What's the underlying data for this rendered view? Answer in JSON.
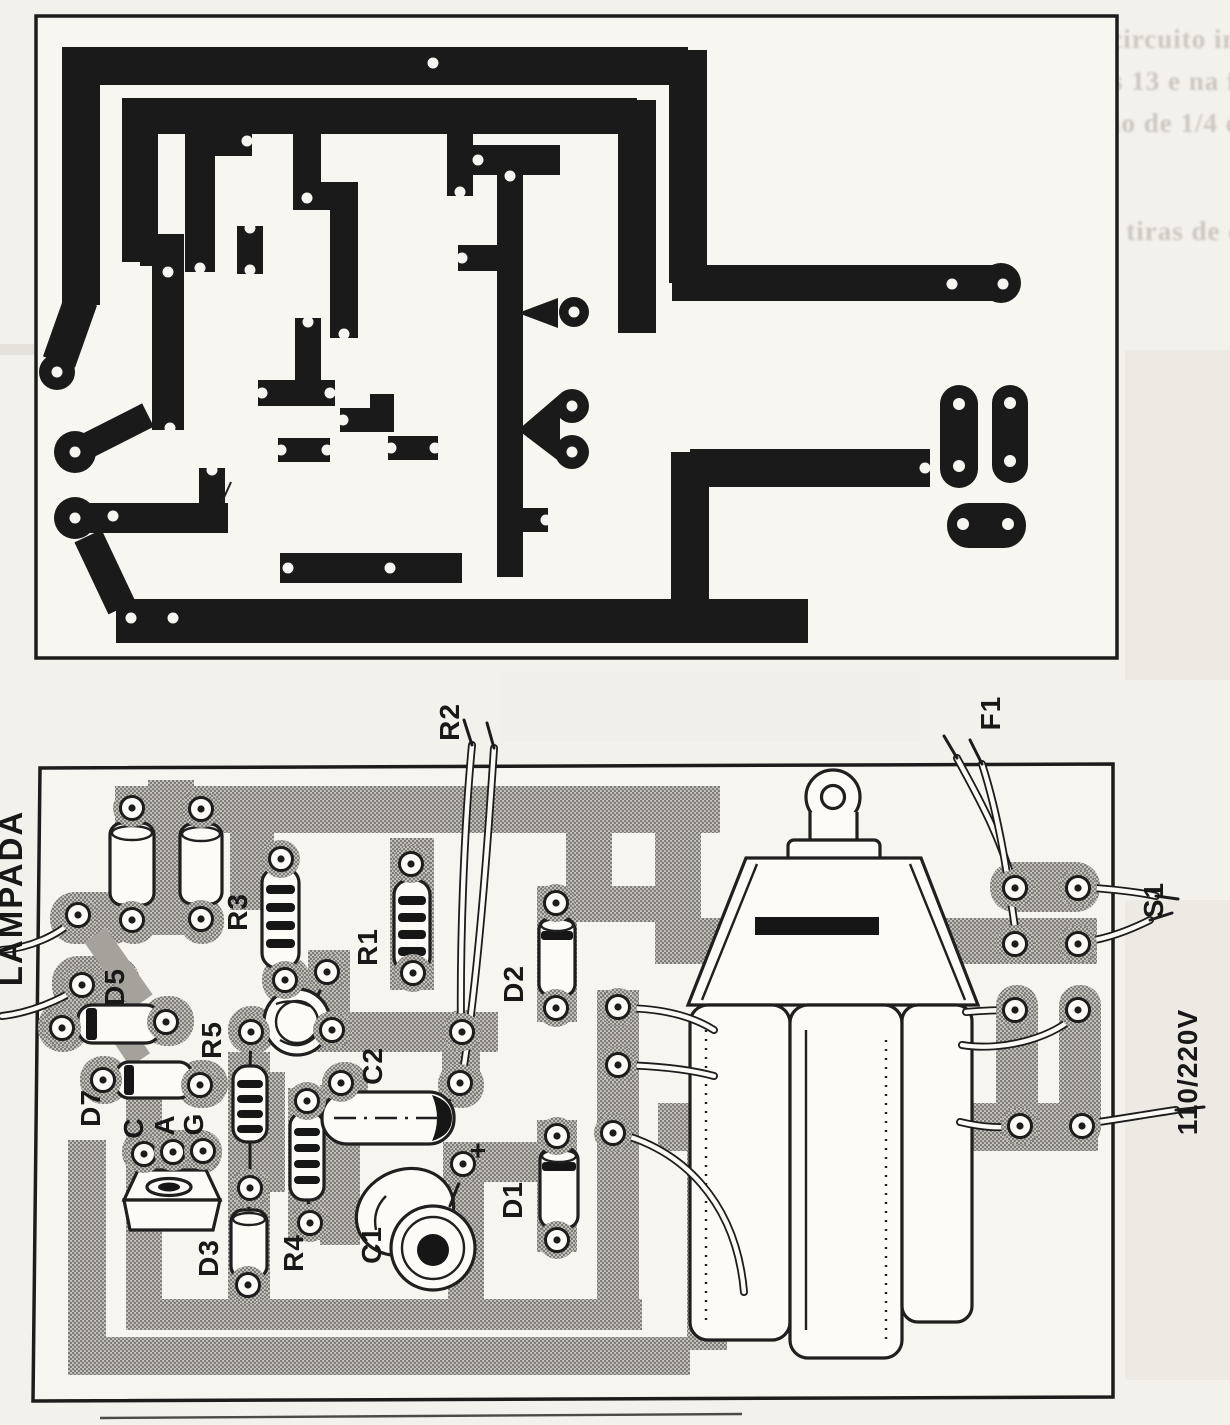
{
  "figure": {
    "description_labels": {
      "lampada": "LAMPADA",
      "r2": "R2",
      "f1": "F1",
      "s1": "S1",
      "voltage": "110/220V",
      "d5": "D5",
      "d7": "D7",
      "d3": "D3",
      "d2": "D2",
      "d1": "D1",
      "r5": "R5",
      "r4": "R4",
      "r3": "R3",
      "r1": "R1",
      "c2": "C2",
      "c1": "C1",
      "plus": "+",
      "pin_c": "C",
      "pin_a": "A",
      "pin_g": "G"
    },
    "ghost_text": {
      "lines": [
        "As placas de circuito impresso",
        "das as figuras 13 e na figura",
        "res  a utilização  de 1/4 ou",
        "A largura das tiras de cobre",
        "par          sua"
      ]
    },
    "colors": {
      "paper": "#f3f1ec",
      "ink": "#1a1a1a",
      "copper_shadow_gray": "#a5a29c"
    }
  }
}
